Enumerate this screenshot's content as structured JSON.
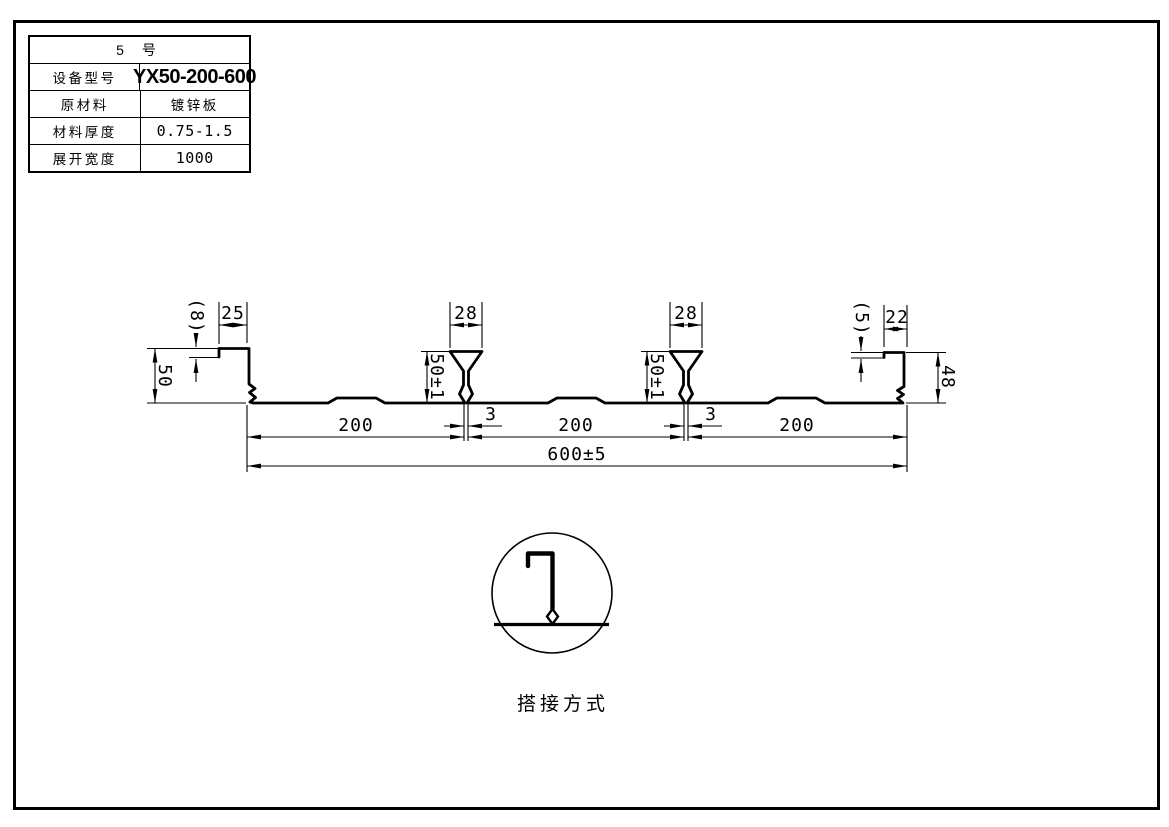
{
  "spec_table": {
    "header": "5 号",
    "rows": [
      {
        "label": "设备型号",
        "value": "YX50-200-600"
      },
      {
        "label": "原材料",
        "value": "镀锌板"
      },
      {
        "label": "材料厚度",
        "value": "0.75-1.5"
      },
      {
        "label": "展开宽度",
        "value": "1000"
      }
    ]
  },
  "dimensions": {
    "left_lip_drop": "(8)",
    "left_lip_width": "25",
    "left_height": "50",
    "rib_top_width": "28",
    "rib_height": "50±1",
    "seam_gap": "3",
    "right_lip_drop": "(5)",
    "right_lip_width": "22",
    "right_height": "48",
    "module_width": "200",
    "overall_width": "600±5"
  },
  "detail": {
    "caption": "搭接方式"
  },
  "colors": {
    "line": "#000000",
    "background": "#ffffff"
  }
}
